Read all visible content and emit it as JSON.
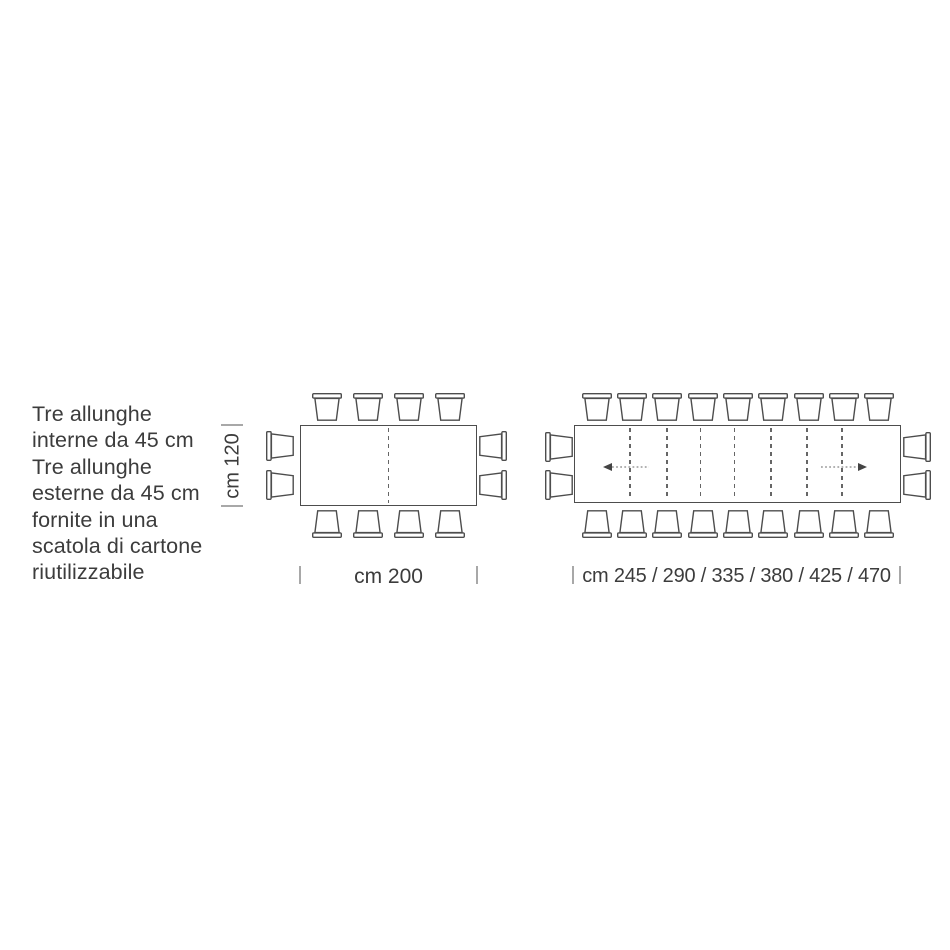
{
  "annotation": {
    "lines": [
      "Tre allunghe",
      "interne da 45 cm",
      "Tre allunghe",
      "esterne da 45 cm",
      "fornite in una",
      "scatola di cartone",
      "riutilizzabile"
    ]
  },
  "left_diagram": {
    "height_label": "cm 120",
    "width_label": "cm 200",
    "chairs": {
      "top": 4,
      "bottom": 4,
      "left": 2,
      "right": 2
    },
    "leaf_lines": 1
  },
  "right_diagram": {
    "width_label": "cm 245 / 290 / 335 / 380 / 425 / 470",
    "chairs": {
      "top": 9,
      "bottom": 9,
      "left": 2,
      "right": 2
    },
    "leaf_lines": 7,
    "extension_arrows": [
      "left",
      "right"
    ]
  },
  "colors": {
    "line": "#4d4d4d",
    "leaf_dash": "#666666",
    "text": "#3c3c3c",
    "tick": "#a8a8a8",
    "arrow_head": "#444444",
    "arrow_dots": "#999999"
  }
}
